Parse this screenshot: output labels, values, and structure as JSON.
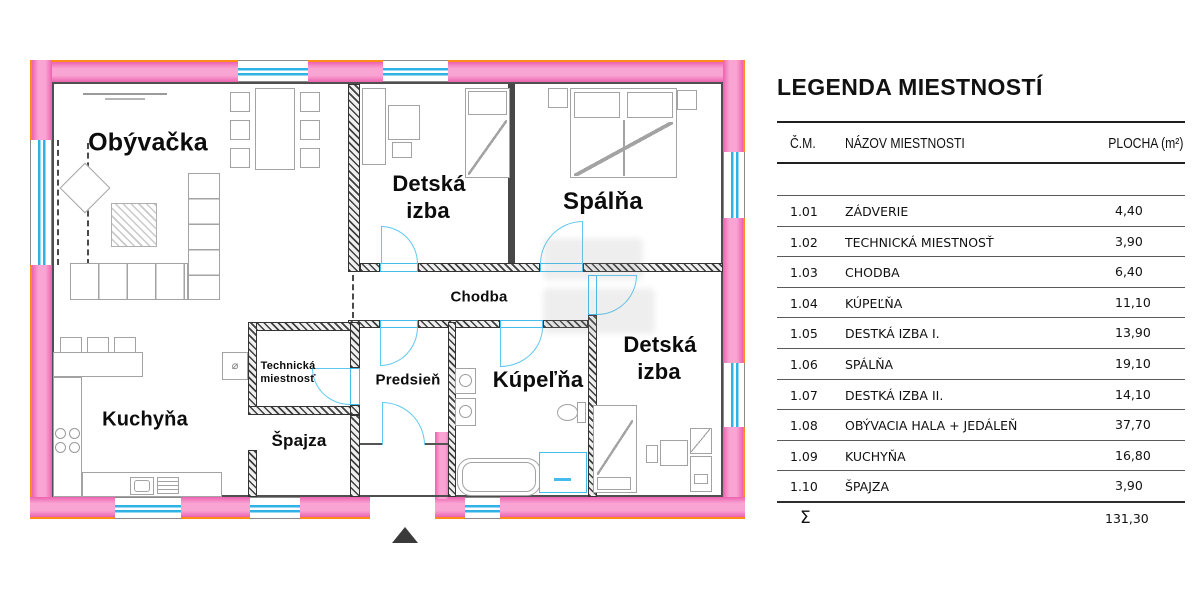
{
  "plan": {
    "labels": {
      "obyvacka": "Obývačka",
      "detska1": [
        "Detská",
        "izba"
      ],
      "spalna": "Spálňa",
      "chodba": "Chodba",
      "technicka": [
        "Technická",
        "miestnosť"
      ],
      "predsien": "Predsieň",
      "kupelna": "Kúpeľňa",
      "detska2": [
        "Detská",
        "izba"
      ],
      "kuchyna": "Kuchyňa",
      "spajza": "Špajza"
    },
    "symbols": {
      "diameter": "⌀"
    }
  },
  "legend": {
    "title": "LEGENDA MIESTNOSTÍ",
    "col_num": "Č.M.",
    "col_name": "NÁZOV MIESTNOSTI",
    "col_area": "PLOCHA (m²)",
    "rows": [
      {
        "num": "1.01",
        "name": "ZÁDVERIE",
        "area": "4,40"
      },
      {
        "num": "1.02",
        "name": "TECHNICKÁ MIESTNOSŤ",
        "area": "3,90"
      },
      {
        "num": "1.03",
        "name": "CHODBA",
        "area": "6,40"
      },
      {
        "num": "1.04",
        "name": "KÚPEĽŇA",
        "area": "11,10"
      },
      {
        "num": "1.05",
        "name": "DESTKÁ IZBA I.",
        "area": "13,90"
      },
      {
        "num": "1.06",
        "name": "SPÁLŇA",
        "area": "19,10"
      },
      {
        "num": "1.07",
        "name": "DESTKÁ IZBA II.",
        "area": "14,10"
      },
      {
        "num": "1.08",
        "name": "OBÝVACIA HALA + JEDÁLEŇ",
        "area": "37,70"
      },
      {
        "num": "1.09",
        "name": "KUCHYŇA",
        "area": "16,80"
      },
      {
        "num": "1.10",
        "name": "ŠPAJZA",
        "area": "3,90"
      }
    ],
    "total_symbol": "Σ",
    "total_area": "131,30"
  },
  "colors": {
    "wall_pink": "#f793cb",
    "wall_outline_orange": "#ff8b1a",
    "glass_cyan": "#2fb2e5",
    "door_cyan": "#5fc8f0"
  }
}
